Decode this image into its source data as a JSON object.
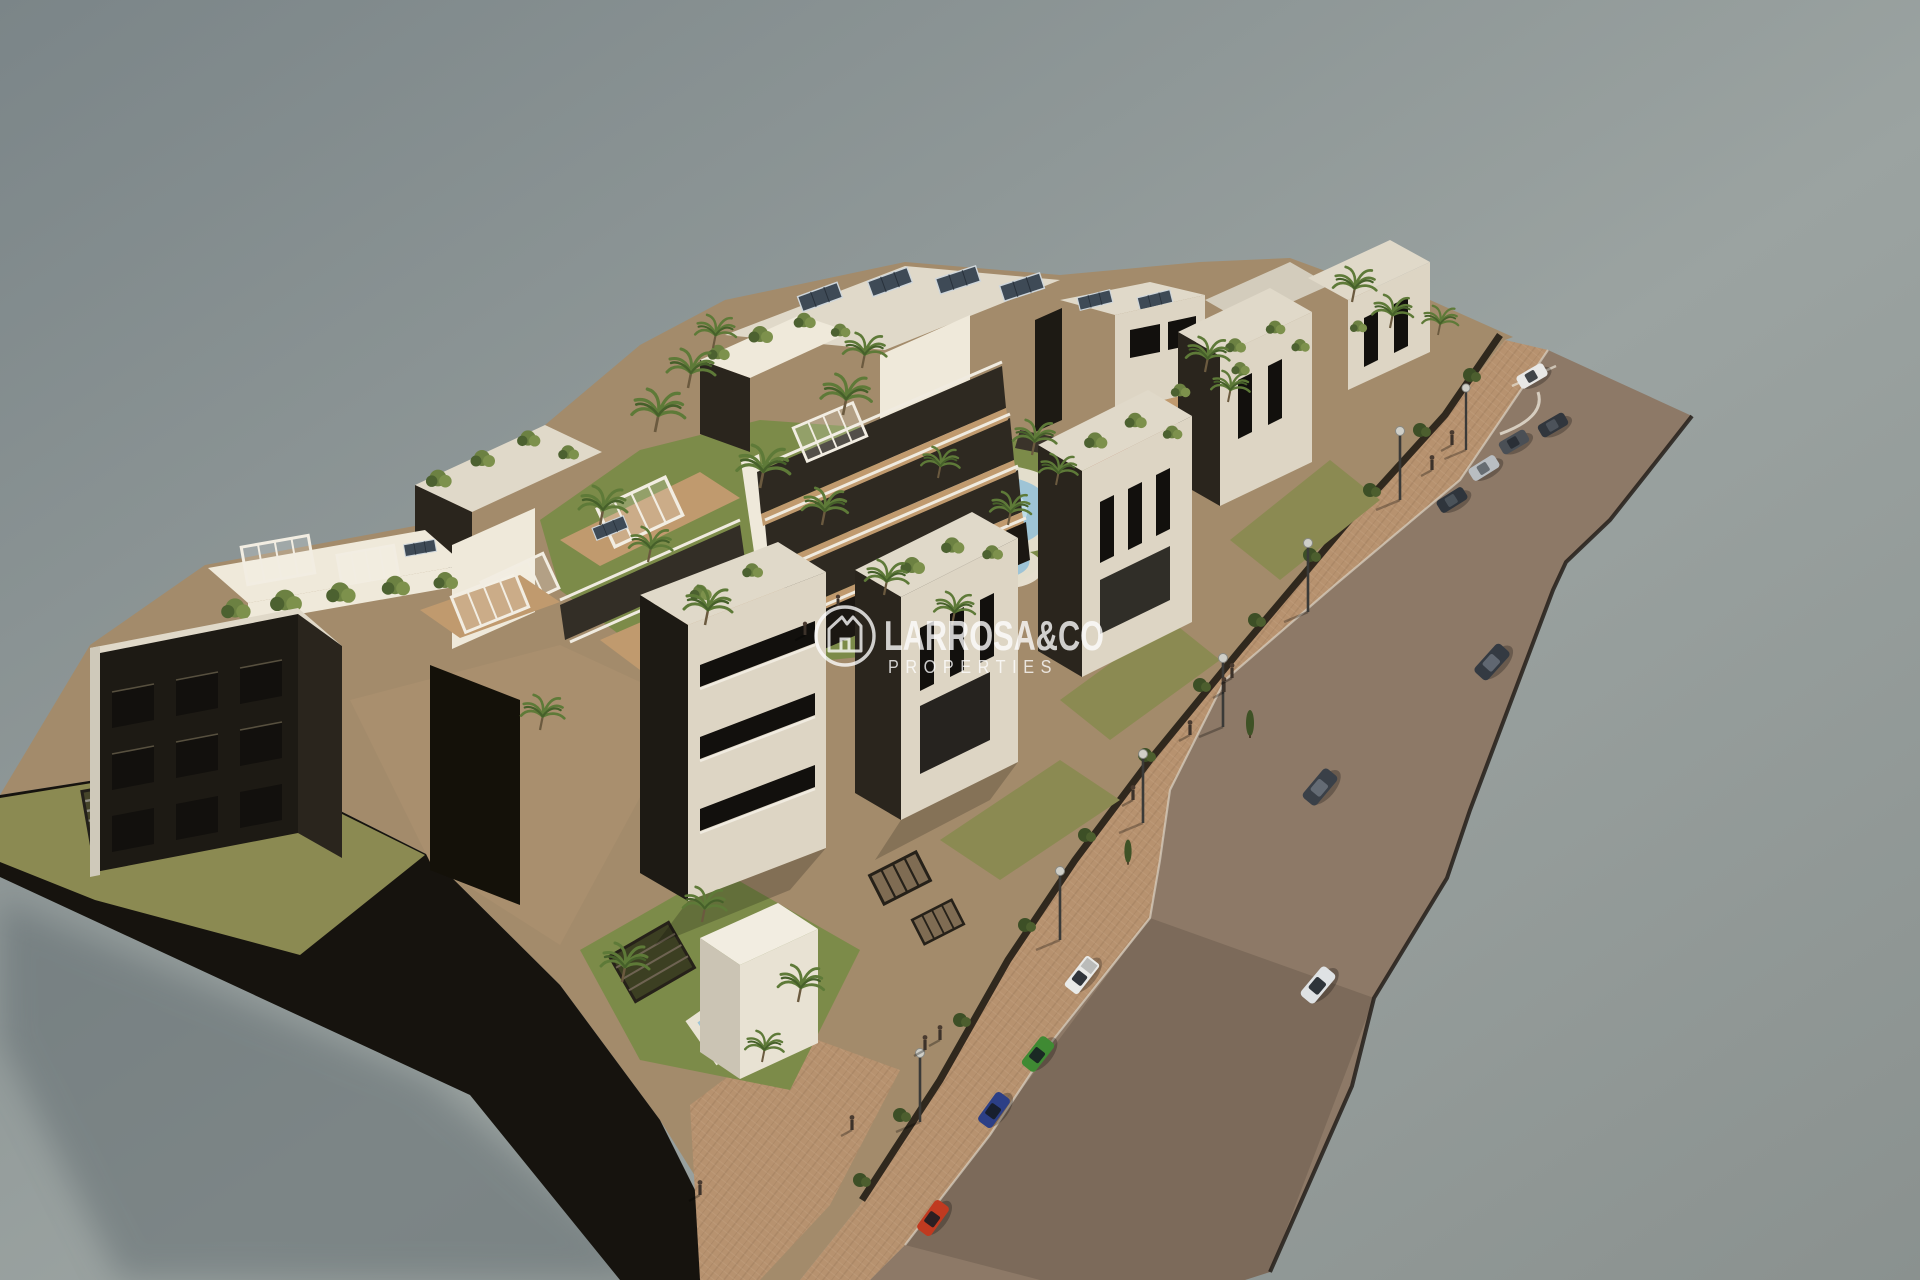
{
  "meta": {
    "title": "Aerial 3D architectural render of residential development",
    "description": "Bird's-eye visualization of a white apartment complex with rooftop terraces, solar panels, communal pool, gardens, palm trees and a diagonal street with parked and moving cars, floating on a plain grey studio background."
  },
  "watermark": {
    "brand": "LARROSA&CO",
    "subtitle": "PROPERTIES",
    "logo": "house-monogram-logo",
    "text_color": "#ffffff"
  },
  "scene": {
    "background": {
      "top_left": "#7b8588",
      "center": "#9ba3a1",
      "bottom_right": "#8a918f"
    },
    "colors": {
      "road": "#8d7967",
      "road_edge": "#241f1a",
      "sidewalk": "#b7926f",
      "curb": "#ded7c9",
      "platform_side": "#16130e",
      "ground": "#a38b6b",
      "courtyard": "#a98f6e",
      "lawn": "#8b8a52",
      "garden": "#7c8b49",
      "path": "#c8b18a",
      "hedge": "#3d4f26",
      "palm": "#5e7a38",
      "shrub": "#6c8142",
      "pool_water": "#9ec4d6",
      "pool_shallow": "#bfdde8",
      "pool_deck": "#e9e3d4",
      "roof": "#e0d9c9",
      "facade_lit": "#ddd5c4",
      "facade_white": "#efe9da",
      "facade_dark": "#1d1a14",
      "facade_shade": "#2a251d",
      "window": "#12100d",
      "wood_deck": "#c09a6e",
      "rail": "#f0ebe0",
      "solar_panel": "#3e4a56",
      "playground": "#b05a41",
      "lamp_head": "#cfcfc8"
    },
    "vehicles": [
      {
        "name": "red-hatchback-parked",
        "color": "#c03a20"
      },
      {
        "name": "blue-sedan-parked",
        "color": "#2c3f86"
      },
      {
        "name": "green-suv-parked",
        "color": "#3f8a33"
      },
      {
        "name": "white-pickup-parked",
        "color": "#e9eae8"
      },
      {
        "name": "white-suv-driving",
        "color": "#dfe2e4"
      },
      {
        "name": "dark-suv-driving-mid",
        "color": "#3a4048"
      },
      {
        "name": "dark-suv-driving-upper",
        "color": "#343a42"
      },
      {
        "name": "dark-car-parked-1",
        "color": "#2f353c"
      },
      {
        "name": "silver-car-parked",
        "color": "#b9bec2"
      },
      {
        "name": "grey-car-parked",
        "color": "#4a4f55"
      },
      {
        "name": "dark-car-parked-2",
        "color": "#31363d"
      },
      {
        "name": "white-car-parked-top",
        "color": "#e8e8e6"
      }
    ],
    "street_furniture": {
      "street_lamps": 7,
      "pedestrians": 12,
      "sun_loungers": 8
    }
  }
}
